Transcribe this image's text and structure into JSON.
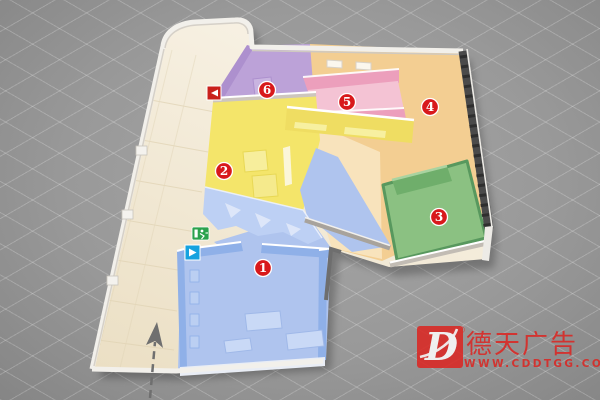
{
  "scene": {
    "type": "isometric-floor-plan-illustration",
    "background_color": "#999999",
    "floor_color": "#F2EAD6",
    "wall_color": "#F2F0EB",
    "dark_wall_color": "#4A4A4A"
  },
  "rooms": [
    {
      "number": "1",
      "color": "#AFC4EE",
      "wall_color": "#8FB0E8",
      "badge_x": 263,
      "badge_y": 268
    },
    {
      "number": "2",
      "color": "#F4E56A",
      "wall_color": "#EFDD62",
      "badge_x": 224,
      "badge_y": 171
    },
    {
      "number": "3",
      "color": "#8BC182",
      "wall_color": "#6FAE6B",
      "badge_x": 439,
      "badge_y": 217
    },
    {
      "number": "4",
      "color": "#F3CE92",
      "wall_color": "#EDBE74",
      "badge_x": 430,
      "badge_y": 107
    },
    {
      "number": "5",
      "color": "#F4C3D4",
      "wall_color": "#EC9FBC",
      "badge_x": 347,
      "badge_y": 102
    },
    {
      "number": "6",
      "color": "#BCA2D8",
      "wall_color": "#AD90CE",
      "badge_x": 267,
      "badge_y": 90
    }
  ],
  "badge": {
    "bg": "#D8191B",
    "ring": "#FFFFFF",
    "text_color": "#FFFFFF"
  },
  "icons": {
    "back_arrow": {
      "bg": "#C9201B",
      "glyph_color": "#FFFFFF"
    },
    "exit_sign": {
      "bg": "#2BA24D",
      "glyph_color": "#FFFFFF"
    },
    "forward_arrow": {
      "bg": "#15A2DF",
      "glyph_color": "#FFFFFF"
    }
  },
  "route_arrow": {
    "color": "#6F6F6F"
  },
  "watermark": {
    "logo_letter": "D",
    "registered": "®",
    "brand": "德天广告",
    "website": "WWW.CDDTGG.COM",
    "color": "#DD2420"
  }
}
